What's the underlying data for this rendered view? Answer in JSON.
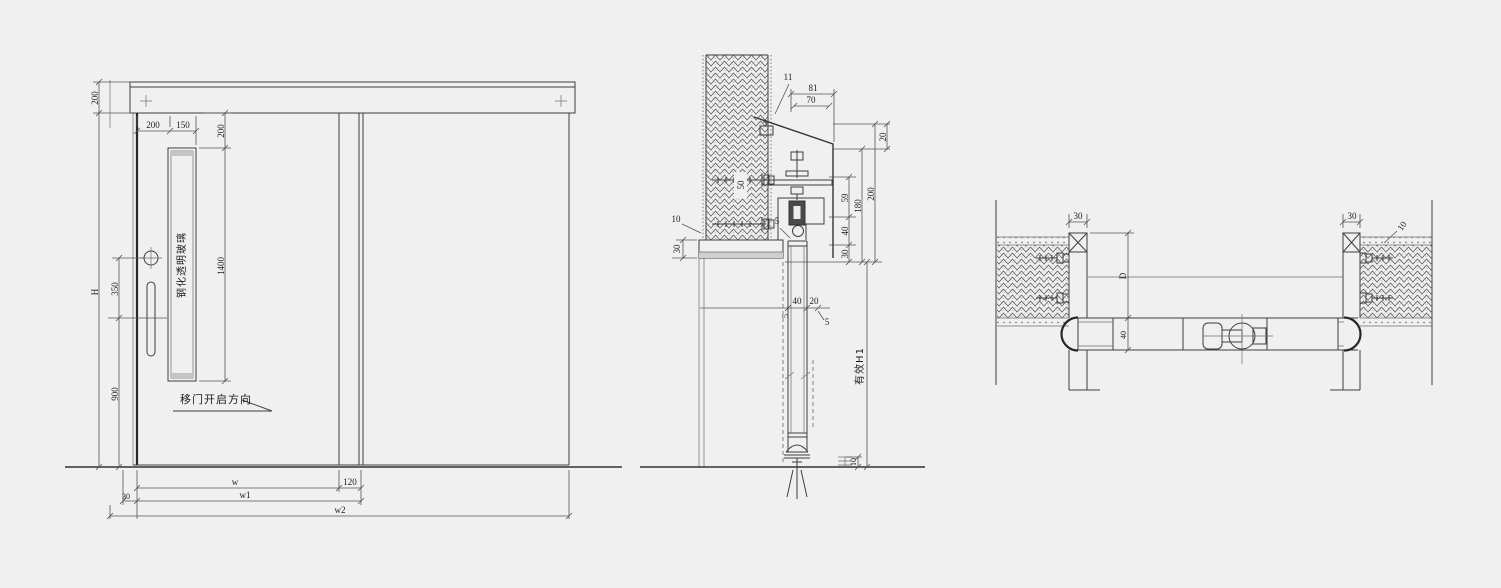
{
  "app": {
    "background": "#f0f0f0",
    "line_color": "#3e3e3e",
    "hatch_color": "#4a4a4a"
  },
  "views": {
    "elevation": {
      "name": "front elevation of sliding door",
      "glass_label": "钢化透明玻璃",
      "open_direction_label": "移门开启方向",
      "dims": {
        "header_height": "200",
        "leading_edge_to_glass": "200",
        "glass_width": "150",
        "glass_top_offset": "200",
        "glass_height": "1400",
        "lock_to_handle": "350",
        "handle_height_above_floor": "900",
        "door_height": "H",
        "leaf_width": "w",
        "overlap": "120",
        "side_clearance": "30",
        "width1": "w1",
        "width2": "w2"
      }
    },
    "vertical_section": {
      "name": "vertical section at head and sill",
      "dims": {
        "gap": "11",
        "cover_total": "81",
        "cover_face": "70",
        "track_top": "20",
        "head_total": "200",
        "head_inner": "180",
        "hanger": "59",
        "roller_zone": "40",
        "head_board": "30",
        "board_thickness": "30",
        "anchor_spacing": "50",
        "wall_edge": "10",
        "head_gap": "5",
        "leaf_thickness": "40",
        "leaf_gap": "20",
        "gap_small": "5",
        "seal_gap": "5",
        "floor_embed": "10",
        "effective_height": "有效H1"
      }
    },
    "plan_section": {
      "name": "horizontal section at jambs",
      "dims": {
        "left_jamb_width": "30",
        "right_jamb_width": "30",
        "wall_edge": "10",
        "jamb_depth": "D",
        "leaf_thickness": "40"
      }
    }
  }
}
